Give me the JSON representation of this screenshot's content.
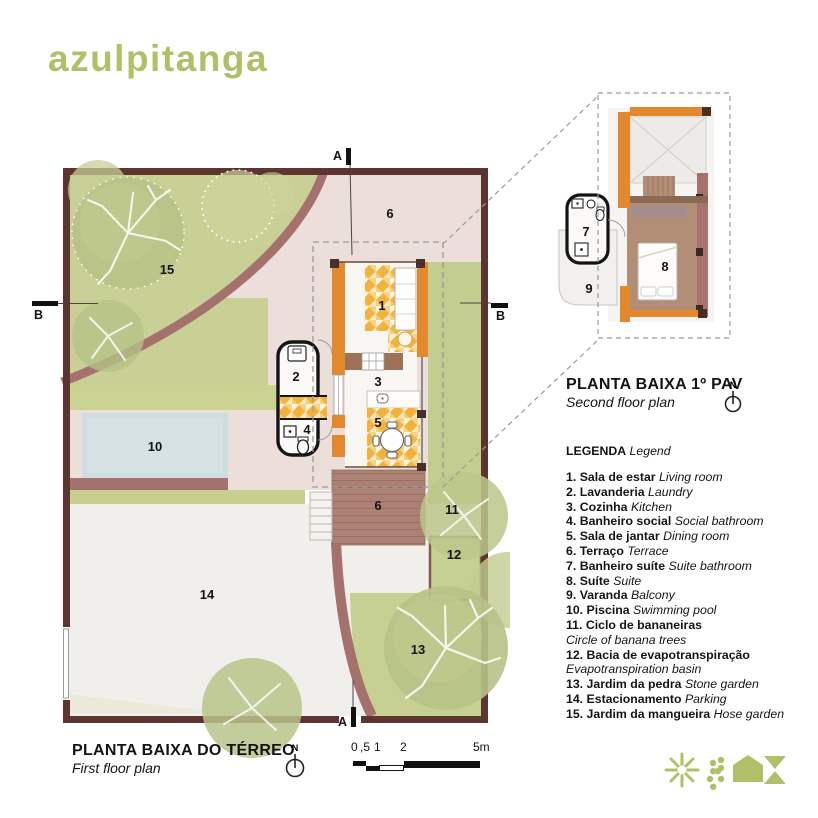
{
  "logo": "azulpitanga",
  "north": {
    "label": "N"
  },
  "plan1": {
    "title": "PLANTA BAIXA DO TÉRREO",
    "subtitle": "First floor plan",
    "labels": {
      "r1": "1",
      "r2": "2",
      "r3": "3",
      "r4": "4",
      "r5": "5",
      "r6": "6",
      "r10": "10",
      "r11": "11",
      "r12": "12",
      "r13": "13",
      "r14": "14",
      "r15": "15"
    },
    "section_a": "A",
    "section_b": "B"
  },
  "plan2": {
    "title": "PLANTA BAIXA 1º PAV",
    "subtitle": "Second floor plan",
    "labels": {
      "r7": "7",
      "r8": "8",
      "r9": "9"
    }
  },
  "legend": {
    "title_pt": "LEGENDA",
    "title_en": "Legend",
    "items": [
      {
        "num": "1.",
        "pt": "Sala de estar",
        "en": "Living room"
      },
      {
        "num": "2.",
        "pt": "Lavanderia",
        "en": "Laundry"
      },
      {
        "num": "3.",
        "pt": "Cozinha",
        "en": "Kitchen"
      },
      {
        "num": "4.",
        "pt": "Banheiro social",
        "en": "Social bathroom"
      },
      {
        "num": "5.",
        "pt": "Sala de jantar",
        "en": "Dining room"
      },
      {
        "num": "6.",
        "pt": "Terraço",
        "en": "Terrace"
      },
      {
        "num": "7.",
        "pt": "Banheiro suíte",
        "en": "Suite bathroom"
      },
      {
        "num": "8.",
        "pt": "Suíte",
        "en": "Suite"
      },
      {
        "num": "9.",
        "pt": "Varanda",
        "en": "Balcony"
      },
      {
        "num": "10.",
        "pt": "Piscina",
        "en": "Swimming pool"
      },
      {
        "num": "11.",
        "pt": "Ciclo de bananeiras",
        "en": "Circle of banana trees"
      },
      {
        "num": "12.",
        "pt": "Bacia de evapotranspiração",
        "en": "Evapotranspiration basin"
      },
      {
        "num": "13.",
        "pt": "Jardim da pedra",
        "en": "Stone garden"
      },
      {
        "num": "14.",
        "pt": "Estacionamento",
        "en": "Parking"
      },
      {
        "num": "15.",
        "pt": "Jardim da mangueira",
        "en": "Hose garden"
      }
    ]
  },
  "scale": {
    "labels": [
      "0",
      ",5",
      "1",
      "2",
      "5m"
    ]
  },
  "footer_icons": {
    "names": [
      "starburst-icon",
      "dotted-circle-icon",
      "house-icon",
      "hourglass-icon"
    ]
  },
  "colors": {
    "brand_green": "#b2bf69",
    "lot_wall": "#5e3430",
    "curved_wall": "#a5716d",
    "orange_wall": "#e4882e",
    "mosaic_yellow": "#f2b23c",
    "patio_pink": "#ecdfda",
    "pool_blue": "#cfdce0",
    "deck_brown": "#aa8173",
    "garden_green": "#c9d096",
    "suite_floor": "#b28e76"
  }
}
